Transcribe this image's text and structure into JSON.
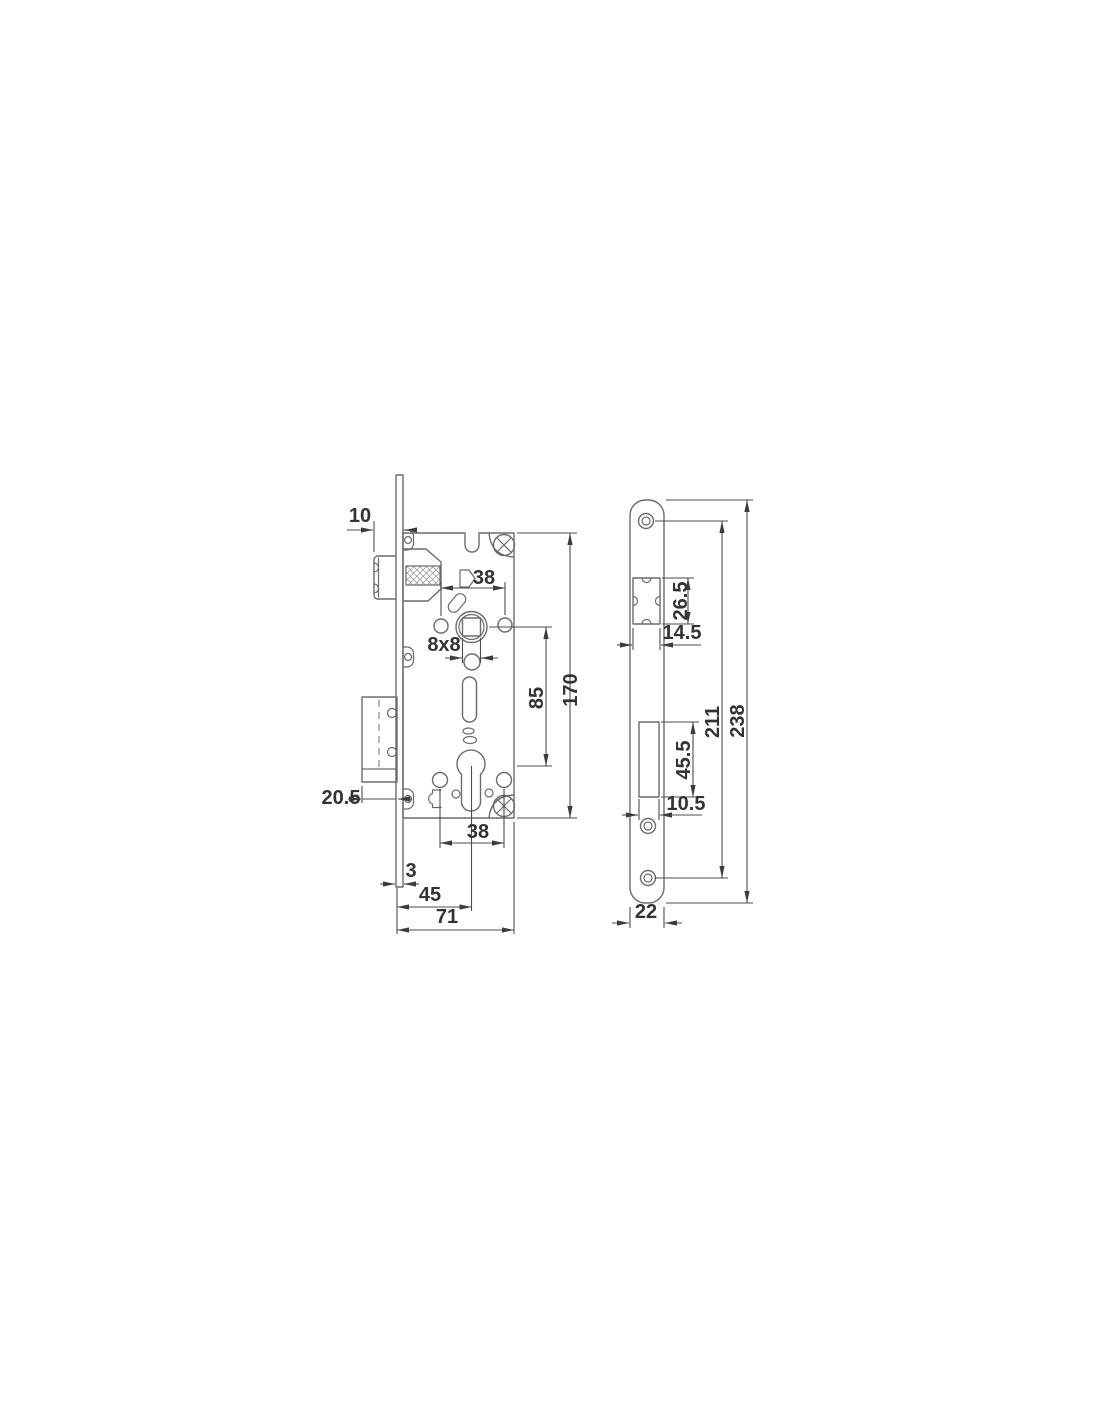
{
  "drawing": {
    "subject": "mortise-lock-technical-drawing",
    "colors": {
      "background": "#ffffff",
      "line": "#6b6b6b",
      "dimension_line": "#4d4d4d",
      "text": "#333333"
    }
  },
  "dims": {
    "lock": {
      "latch_protrusion": "10",
      "hub_hole_spacing": "38",
      "follower_square": "8x8",
      "hub_to_cylinder": "85",
      "case_height": "170",
      "deadbolt_throw": "20.5",
      "faceplate_thickness": "3",
      "backset": "45",
      "case_depth": "71",
      "cylinder_hole_spacing": "38"
    },
    "plate": {
      "latch_cutout_height": "26.5",
      "latch_cutout_width": "14.5",
      "screw_center_distance": "211",
      "plate_length": "238",
      "deadbolt_cutout_height": "45.5",
      "deadbolt_cutout_width": "10.5",
      "plate_width": "22"
    }
  }
}
